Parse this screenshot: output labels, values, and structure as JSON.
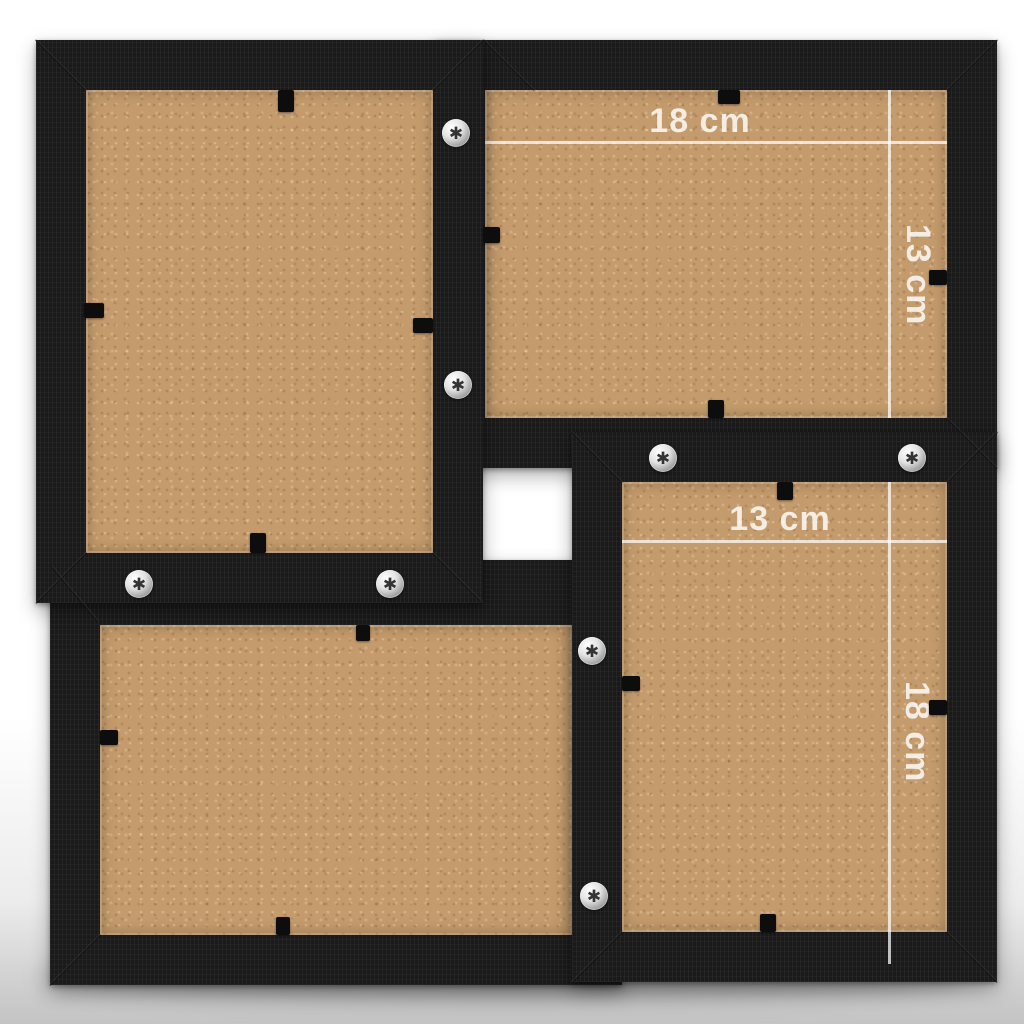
{
  "scene": {
    "description": "Back view of a black wooden 4-photo collage frame with tan MDF backings, metal fixing screws, black rotating tabs and white photo-size dimension overlays"
  },
  "palette": {
    "background_top": "#ffffff",
    "background_bottom": "#c4c4c4",
    "frame_black": "#1a1a1a",
    "backing_tan": "#c49b6c",
    "dimension_line": "rgba(255,255,255,0.72)",
    "dimension_text": "rgba(255,255,255,0.82)",
    "screw_silver": "#e2e2e2",
    "tab_black": "#0d0d0d"
  },
  "frames": {
    "top_left": {
      "orientation": "portrait"
    },
    "top_right": {
      "orientation": "landscape",
      "width_label": "18 cm",
      "height_label": "13 cm"
    },
    "bottom_left": {
      "orientation": "landscape"
    },
    "bottom_right": {
      "orientation": "portrait",
      "width_label": "13 cm",
      "height_label": "18 cm"
    }
  },
  "icons": {
    "screw_glyph": "✱"
  },
  "hardware": {
    "screws": [
      {
        "x": 456,
        "y": 133
      },
      {
        "x": 458,
        "y": 385
      },
      {
        "x": 139,
        "y": 584
      },
      {
        "x": 390,
        "y": 584
      },
      {
        "x": 663,
        "y": 458
      },
      {
        "x": 912,
        "y": 458
      },
      {
        "x": 592,
        "y": 651
      },
      {
        "x": 594,
        "y": 896
      }
    ],
    "tabs": [
      {
        "x": 278,
        "y": 90,
        "w": 16,
        "h": 22
      },
      {
        "x": 84,
        "y": 303,
        "w": 20,
        "h": 15
      },
      {
        "x": 413,
        "y": 318,
        "w": 20,
        "h": 15
      },
      {
        "x": 250,
        "y": 533,
        "w": 16,
        "h": 20
      },
      {
        "x": 483,
        "y": 227,
        "w": 17,
        "h": 16
      },
      {
        "x": 718,
        "y": 90,
        "w": 22,
        "h": 14
      },
      {
        "x": 929,
        "y": 270,
        "w": 18,
        "h": 15
      },
      {
        "x": 708,
        "y": 400,
        "w": 16,
        "h": 18
      },
      {
        "x": 777,
        "y": 482,
        "w": 16,
        "h": 18
      },
      {
        "x": 622,
        "y": 676,
        "w": 18,
        "h": 15
      },
      {
        "x": 929,
        "y": 700,
        "w": 18,
        "h": 15
      },
      {
        "x": 760,
        "y": 914,
        "w": 16,
        "h": 18
      },
      {
        "x": 356,
        "y": 625,
        "w": 14,
        "h": 16
      },
      {
        "x": 100,
        "y": 730,
        "w": 18,
        "h": 15
      },
      {
        "x": 276,
        "y": 917,
        "w": 14,
        "h": 18
      }
    ]
  },
  "miters": [
    {
      "x": 61,
      "y": 65,
      "r": 45
    },
    {
      "x": 458,
      "y": 65,
      "r": -45
    },
    {
      "x": 61,
      "y": 578,
      "r": -45
    },
    {
      "x": 458,
      "y": 578,
      "r": 45
    },
    {
      "x": 509,
      "y": 65,
      "r": 45
    },
    {
      "x": 972,
      "y": 65,
      "r": -45
    },
    {
      "x": 972,
      "y": 443,
      "r": 45
    },
    {
      "x": 597,
      "y": 457,
      "r": 45
    },
    {
      "x": 972,
      "y": 457,
      "r": -45
    },
    {
      "x": 597,
      "y": 957,
      "r": -45
    },
    {
      "x": 972,
      "y": 957,
      "r": 45
    },
    {
      "x": 75,
      "y": 594,
      "r": 50
    },
    {
      "x": 75,
      "y": 960,
      "r": -45
    }
  ]
}
